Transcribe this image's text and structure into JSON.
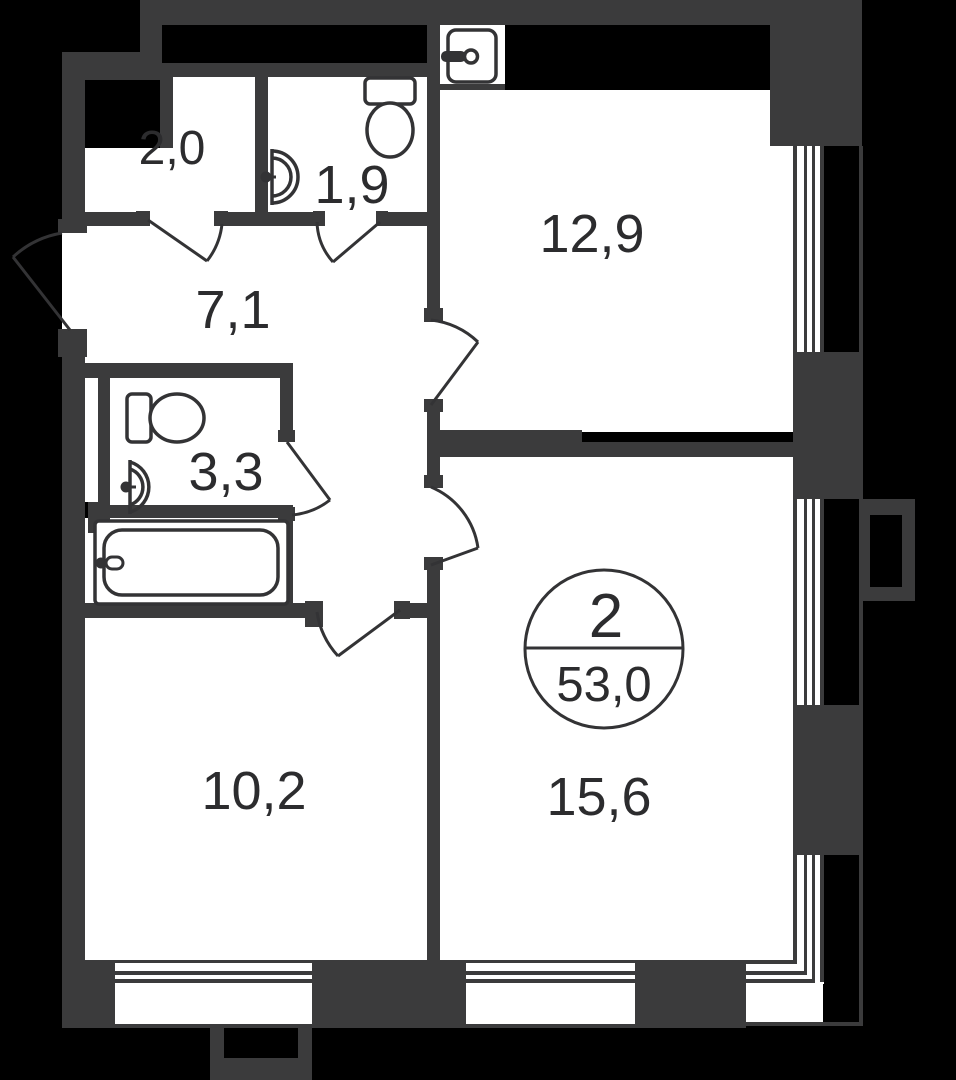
{
  "plan": {
    "badge": {
      "room_count": "2",
      "total_area": "53,0"
    },
    "rooms": [
      {
        "name": "wardrobe",
        "area": "2,0"
      },
      {
        "name": "wc",
        "area": "1,9"
      },
      {
        "name": "kitchen",
        "area": "12,9"
      },
      {
        "name": "hallway",
        "area": "7,1"
      },
      {
        "name": "bathroom",
        "area": "3,3"
      },
      {
        "name": "bedroom",
        "area": "10,2"
      },
      {
        "name": "living-room",
        "area": "15,6"
      }
    ],
    "colors": {
      "background": "#000000",
      "wall": "#3b3b3c",
      "floor": "#ffffff",
      "line": "#333335",
      "text": "#2c2c2e"
    }
  }
}
